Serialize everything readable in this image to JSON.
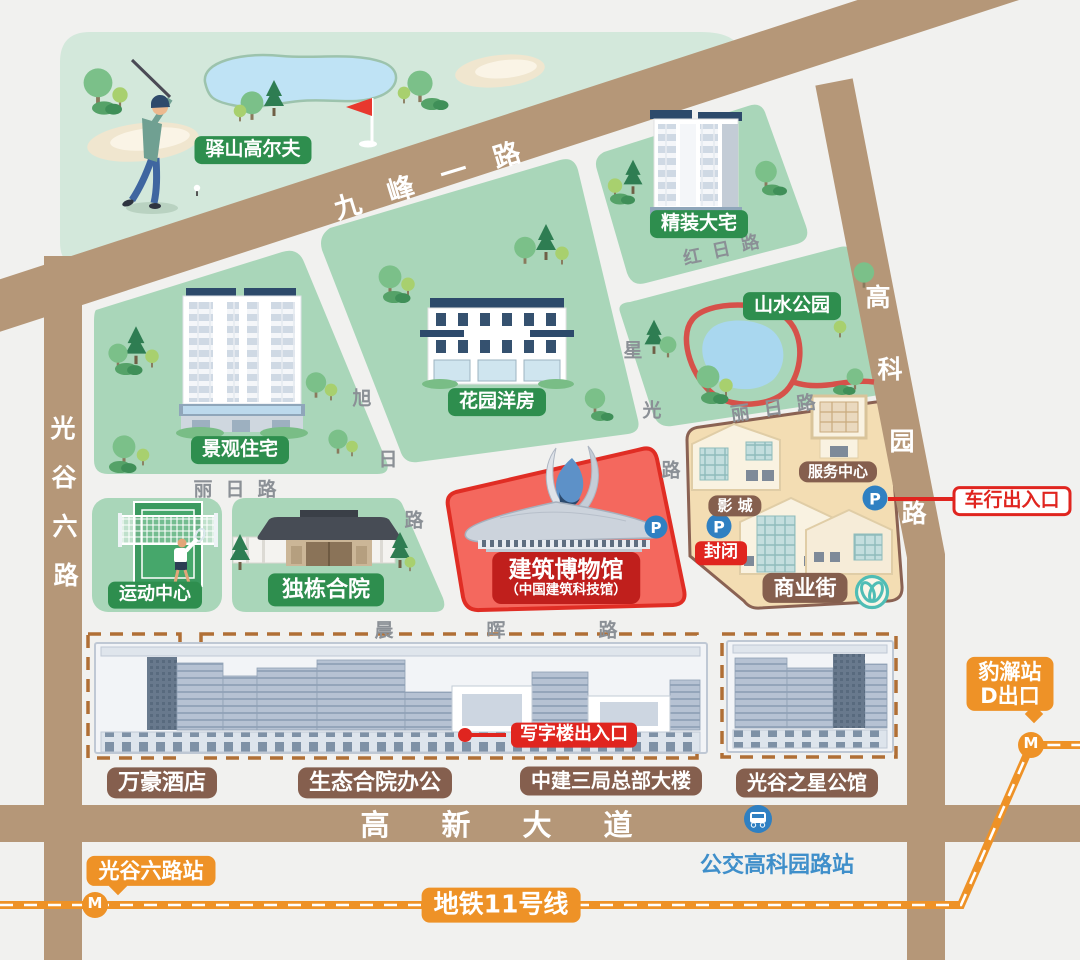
{
  "colors": {
    "road": "#b59778",
    "block_green": "#a9d6b9",
    "golf_green": "#d3e8db",
    "badge_green": "#2e8e4e",
    "badge_brown": "#855f4e",
    "red": "#e0251f",
    "museum_red": "#c01f1c",
    "zone_red": "#f4685e",
    "tan": "#f3ddb3",
    "orange": "#ee9227",
    "blue": "#2f80c2",
    "bus_text_blue": "#3f8fca",
    "teal": "#4fbdb5"
  },
  "golf": {
    "label": "驿山高尔夫"
  },
  "zones": {
    "jingguan": "景观住宅",
    "huayuan": "花园洋房",
    "jingzhuang": "精装大宅",
    "shanshui": "山水公园",
    "yundong": "运动中心",
    "dudong": "独栋合院"
  },
  "museum": {
    "name": "建筑博物馆",
    "alt": "（中国建筑科技馆）"
  },
  "commercial": {
    "service": "服务中心",
    "cinema": "影 城",
    "street": "商业街"
  },
  "offices": {
    "hotel": "万豪酒店",
    "eco": "生态合院办公",
    "hq": "中建三局总部大楼",
    "star": "光谷之星公馆"
  },
  "roads": {
    "jiufeng": "九峰一路",
    "guanggu6": "光谷六路",
    "gaokeyuan": "高科园路",
    "gaoxin": "高新大道",
    "hongri": "红日路",
    "xuri": "旭日路",
    "xingguang": "星光路",
    "liri_west": "丽日路",
    "liri_east": "丽日路",
    "chenhui": "晨晖路"
  },
  "markers": {
    "closed": "封闭",
    "car_gate": "车行出入口",
    "office_gate": "写字楼出入口"
  },
  "transit": {
    "line": "地铁11号线",
    "west_station": "光谷六路站",
    "east_station_name": "豹澥站",
    "east_station_exit": "D出口",
    "bus_stop": "公交高科园路站",
    "metro_symbol": "M",
    "parking_symbol": "P"
  }
}
